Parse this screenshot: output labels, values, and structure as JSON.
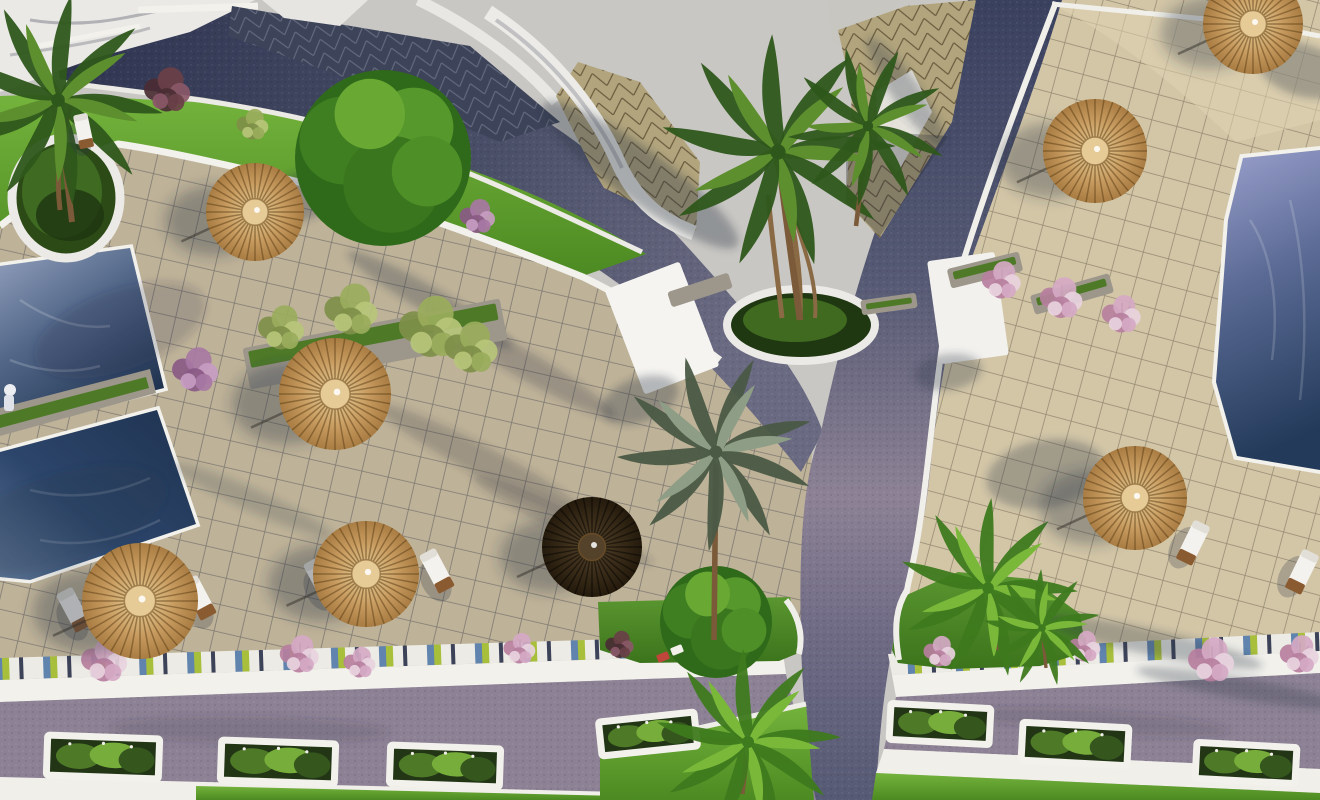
{
  "meta": {
    "kind": "3d-aerial-architectural-render",
    "description": "Bird's-eye 3D rendering of a resort courtyard: blue swimming pools, beige tiled plazas, dark cobbled roads crossing at a junction, lawns, palm trees, thatched straw umbrellas, sun loungers and white planter boxes.",
    "width": 1320,
    "height": 800
  },
  "palette": {
    "ground": "#c9c7c3",
    "roof_white": "#eae9e5",
    "tile_left": "#beb298",
    "tile_right": "#d3c6a7",
    "road_dark": "#3a415f",
    "road_mid": "#565a74",
    "road_light": "#8d8295",
    "curb_white": "#f2f1ec",
    "lawn_light": "#74b33c",
    "lawn_dark": "#4c8a22",
    "pool_light": "#93a0bd",
    "pool_mid": "#54698a",
    "pool_deep": "#1f3350",
    "umbrella_light": "#ecd6a8",
    "umbrella_mid": "#c79b5f",
    "umbrella_deep": "#a87c42",
    "umbrella_dark": "#3c2e1a",
    "stone": "#9d978b",
    "wood": "#7a5a38",
    "planter_green": "#223616",
    "grass_green": "#4e7a28",
    "shadow": "#2d3444"
  },
  "scene": {
    "bush_schemes": {
      "pink": [
        "#b77f9e",
        "#d5a9c4",
        "#e8d2de"
      ],
      "maroon": [
        "#4a2c34",
        "#6a4048",
        "#8a5868"
      ],
      "olive": [
        "#7e8f48",
        "#9aac5c",
        "#b7c67a"
      ],
      "purple": [
        "#8a5a86",
        "#a878a4",
        "#c79cc2"
      ]
    },
    "palm_tones": {
      "dark": [
        "#2e571b",
        "#5d8f2e"
      ],
      "bright": [
        "#3e7a1e",
        "#7ab83a"
      ],
      "silver": [
        "#4a5a44",
        "#8e9e86"
      ]
    },
    "umbrellas": [
      {
        "x": 255,
        "y": 212,
        "r": 49,
        "shade": "straw"
      },
      {
        "x": 335,
        "y": 394,
        "r": 56,
        "shade": "straw"
      },
      {
        "x": 140,
        "y": 601,
        "r": 58,
        "shade": "straw"
      },
      {
        "x": 366,
        "y": 574,
        "r": 53,
        "shade": "straw"
      },
      {
        "x": 592,
        "y": 547,
        "r": 50,
        "shade": "dark"
      },
      {
        "x": 1095,
        "y": 151,
        "r": 52,
        "shade": "straw"
      },
      {
        "x": 1253,
        "y": 24,
        "r": 50,
        "shade": "straw"
      },
      {
        "x": 1135,
        "y": 498,
        "r": 52,
        "shade": "straw"
      }
    ],
    "palms": [
      {
        "x": 58,
        "y": 100,
        "s": 1.7,
        "tone": "dark",
        "rot": 10,
        "trunk": [
          14,
          122
        ]
      },
      {
        "x": 778,
        "y": 152,
        "s": 1.9,
        "tone": "dark",
        "rot": 0,
        "trunk": [
          22,
          168
        ]
      },
      {
        "x": 868,
        "y": 126,
        "s": 1.3,
        "tone": "dark",
        "rot": 25,
        "trunk": [
          -12,
          100
        ]
      },
      {
        "x": 716,
        "y": 452,
        "s": 1.6,
        "tone": "silver",
        "rot": -15,
        "trunk": [
          -2,
          188
        ]
      },
      {
        "x": 988,
        "y": 588,
        "s": 1.45,
        "tone": "bright",
        "rot": 5,
        "trunk": [
          10,
          62
        ]
      },
      {
        "x": 1042,
        "y": 628,
        "s": 0.95,
        "tone": "bright",
        "rot": 40,
        "trunk": [
          4,
          40
        ]
      },
      {
        "x": 748,
        "y": 742,
        "s": 1.5,
        "tone": "bright",
        "rot": 0,
        "trunk": [
          -6,
          52
        ]
      }
    ],
    "round_trees": [
      {
        "x": 383,
        "y": 158,
        "r": 88
      },
      {
        "x": 716,
        "y": 622,
        "r": 56
      }
    ],
    "loungers": [
      {
        "x": 75,
        "y": 612,
        "rot": -28,
        "s": 1
      },
      {
        "x": 200,
        "y": 600,
        "rot": -28,
        "s": 1
      },
      {
        "x": 322,
        "y": 582,
        "rot": -28,
        "s": 1
      },
      {
        "x": 438,
        "y": 573,
        "rot": -28,
        "s": 1
      },
      {
        "x": 1192,
        "y": 545,
        "rot": 26,
        "s": 1
      },
      {
        "x": 1301,
        "y": 574,
        "rot": 26,
        "s": 1
      },
      {
        "x": 84,
        "y": 133,
        "rot": -12,
        "s": 0.8
      }
    ],
    "planter_boxes": [
      {
        "x": 103,
        "y": 757,
        "w": 112,
        "h": 40,
        "rot": 2
      },
      {
        "x": 278,
        "y": 762,
        "w": 114,
        "h": 40,
        "rot": 2
      },
      {
        "x": 445,
        "y": 766,
        "w": 110,
        "h": 38,
        "rot": 2
      },
      {
        "x": 648,
        "y": 734,
        "w": 96,
        "h": 34,
        "rot": -6
      },
      {
        "x": 940,
        "y": 724,
        "w": 100,
        "h": 36,
        "rot": 3
      },
      {
        "x": 1075,
        "y": 744,
        "w": 106,
        "h": 38,
        "rot": 3
      },
      {
        "x": 1246,
        "y": 763,
        "w": 100,
        "h": 36,
        "rot": 3
      }
    ],
    "stone_walls": [
      {
        "x": 375,
        "y": 344,
        "w": 262,
        "h": 42,
        "rot": -11,
        "grass": true
      },
      {
        "x": 985,
        "y": 270,
        "w": 74,
        "h": 20,
        "rot": -14,
        "grass": true
      },
      {
        "x": 1072,
        "y": 294,
        "w": 82,
        "h": 20,
        "rot": -16,
        "grass": true
      },
      {
        "x": 700,
        "y": 290,
        "w": 64,
        "h": 16,
        "rot": -18,
        "grass": false
      },
      {
        "x": 889,
        "y": 304,
        "w": 56,
        "h": 15,
        "rot": -8,
        "grass": true
      }
    ],
    "flower_bushes": [
      {
        "x": 168,
        "y": 92,
        "r": 26,
        "c": "maroon"
      },
      {
        "x": 253,
        "y": 126,
        "r": 18,
        "c": "olive"
      },
      {
        "x": 438,
        "y": 196,
        "r": 24,
        "c": "purple"
      },
      {
        "x": 478,
        "y": 218,
        "r": 20,
        "c": "purple"
      },
      {
        "x": 196,
        "y": 372,
        "r": 26,
        "c": "purple"
      },
      {
        "x": 282,
        "y": 330,
        "r": 26,
        "c": "olive"
      },
      {
        "x": 352,
        "y": 312,
        "r": 30,
        "c": "olive"
      },
      {
        "x": 432,
        "y": 330,
        "r": 36,
        "c": "olive"
      },
      {
        "x": 472,
        "y": 350,
        "r": 30,
        "c": "olive"
      },
      {
        "x": 1002,
        "y": 282,
        "r": 22,
        "c": "pink"
      },
      {
        "x": 1062,
        "y": 300,
        "r": 24,
        "c": "pink"
      },
      {
        "x": 1122,
        "y": 316,
        "r": 22,
        "c": "pink"
      },
      {
        "x": 105,
        "y": 662,
        "r": 26,
        "c": "pink"
      },
      {
        "x": 300,
        "y": 656,
        "r": 22,
        "c": "pink"
      },
      {
        "x": 360,
        "y": 664,
        "r": 18,
        "c": "pink"
      },
      {
        "x": 520,
        "y": 650,
        "r": 18,
        "c": "pink"
      },
      {
        "x": 620,
        "y": 646,
        "r": 16,
        "c": "maroon"
      },
      {
        "x": 940,
        "y": 653,
        "r": 18,
        "c": "pink"
      },
      {
        "x": 1085,
        "y": 648,
        "r": 18,
        "c": "pink"
      },
      {
        "x": 1212,
        "y": 662,
        "r": 26,
        "c": "pink"
      },
      {
        "x": 1300,
        "y": 656,
        "r": 22,
        "c": "pink"
      }
    ],
    "mini_chairs": [
      {
        "x": 663,
        "y": 657,
        "rot": -22,
        "c": "#c0453a"
      },
      {
        "x": 677,
        "y": 650,
        "rot": -22,
        "c": "#f2f0ea"
      }
    ],
    "shadow_blobs": [
      {
        "x": 302,
        "y": 196,
        "rx": 60,
        "ry": 24,
        "rot": -18,
        "o": 0.32
      },
      {
        "x": 430,
        "y": 300,
        "rx": 95,
        "ry": 13,
        "rot": 30,
        "o": 0.3
      },
      {
        "x": 520,
        "y": 362,
        "rx": 110,
        "ry": 14,
        "rot": 30,
        "o": 0.26
      },
      {
        "x": 484,
        "y": 462,
        "rx": 120,
        "ry": 15,
        "rot": 28,
        "o": 0.24
      },
      {
        "x": 562,
        "y": 520,
        "rx": 100,
        "ry": 12,
        "rot": 26,
        "o": 0.24
      },
      {
        "x": 252,
        "y": 500,
        "rx": 88,
        "ry": 11,
        "rot": 24,
        "o": 0.2
      },
      {
        "x": 120,
        "y": 330,
        "rx": 90,
        "ry": 40,
        "rot": -20,
        "o": 0.18
      },
      {
        "x": 60,
        "y": 520,
        "rx": 110,
        "ry": 45,
        "rot": -18,
        "o": 0.2
      },
      {
        "x": 640,
        "y": 175,
        "rx": 120,
        "ry": 26,
        "rot": 36,
        "o": 0.35
      },
      {
        "x": 906,
        "y": 92,
        "rx": 66,
        "ry": 14,
        "rot": 55,
        "o": 0.3
      },
      {
        "x": 1150,
        "y": 642,
        "rx": 115,
        "ry": 13,
        "rot": 12,
        "o": 0.3
      },
      {
        "x": 1240,
        "y": 688,
        "rx": 105,
        "ry": 11,
        "rot": 10,
        "o": 0.3
      },
      {
        "x": 1302,
        "y": 70,
        "rx": 46,
        "ry": 26,
        "rot": 18,
        "o": 0.32
      },
      {
        "x": 640,
        "y": 400,
        "rx": 40,
        "ry": 22,
        "rot": -20,
        "o": 0.32
      },
      {
        "x": 948,
        "y": 372,
        "rx": 34,
        "ry": 18,
        "rot": -8,
        "o": 0.3
      },
      {
        "x": 1046,
        "y": 474,
        "rx": 60,
        "ry": 34,
        "rot": -10,
        "o": 0.3
      },
      {
        "x": 250,
        "y": 730,
        "rx": 140,
        "ry": 14,
        "rot": 1,
        "o": 0.15
      },
      {
        "x": 1100,
        "y": 722,
        "rx": 130,
        "ry": 12,
        "rot": 4,
        "o": 0.15
      }
    ]
  }
}
